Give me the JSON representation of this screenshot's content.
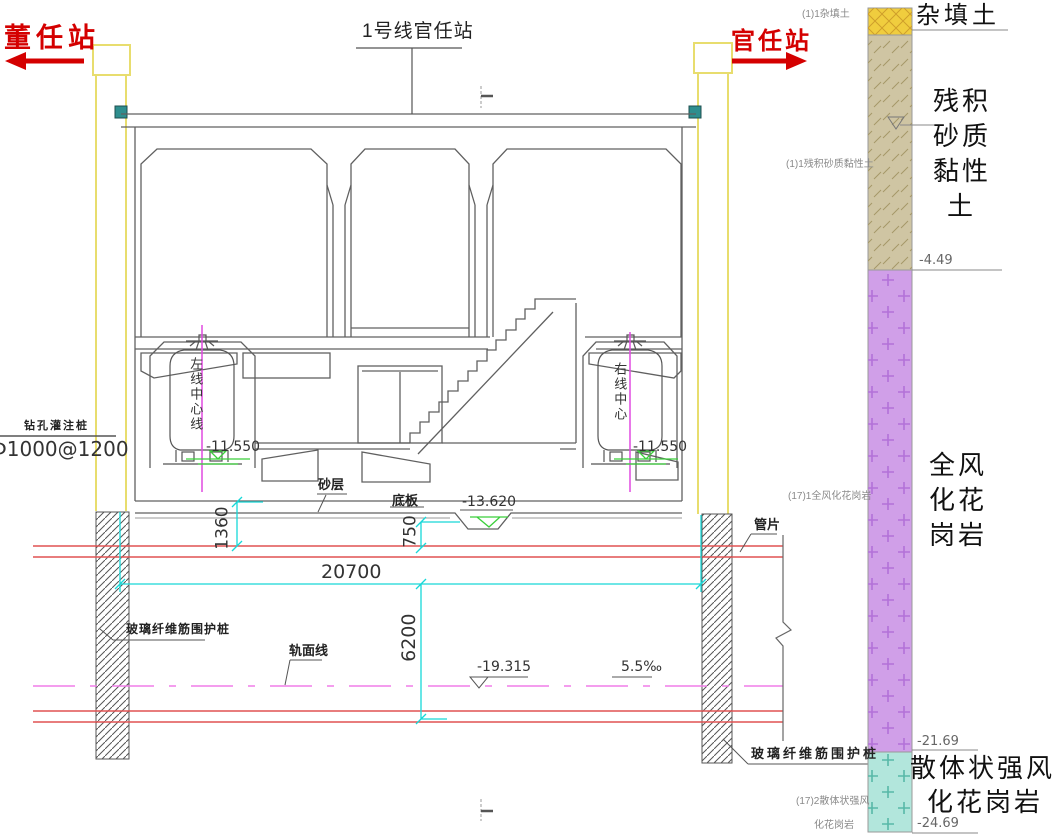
{
  "header": {
    "title": "1号线官任站",
    "left_station": "董任站",
    "right_station": "官任站"
  },
  "annotations": {
    "bored_pile_name": "钻孔灌注桩",
    "bored_pile_spec": "Φ1000@1200",
    "left_center_line": "左线中心线",
    "right_center_line": "右线中心",
    "left_tunnel_elev": "-11.550",
    "right_tunnel_elev": "-11.550",
    "sand_layer": "砂层",
    "base_slab": "底板",
    "sump_elev": "-13.620",
    "segment": "管片",
    "rail_line": "轨面线",
    "rail_elev": "-19.315",
    "slope": "5.5‰",
    "fiberglass_pile_left": "玻璃纤维筋围护桩",
    "fiberglass_pile_right": "玻璃纤维筋围护桩"
  },
  "dimensions": {
    "station_width": "20700",
    "slab_to_tunnel_crown": "1360",
    "sump_depth": "750",
    "tunnel_zone_height": "6200"
  },
  "strata_notes": {
    "fill": "(1)1杂填土",
    "residual": "(1)1残积砂质黏性土",
    "granite_full": "(17)1全风化花岗岩",
    "granite_strong_line1": "(17)2散体状强风",
    "granite_strong_line2": "化花岗岩"
  },
  "geo_column": {
    "fill_label": "杂填土",
    "residual_lines": [
      "残积",
      "砂质",
      "黏性",
      "土"
    ],
    "granite_full_lines": [
      "全风",
      "化花",
      "岗岩"
    ],
    "granite_strong_lines": [
      "散体状强风",
      "化花岗岩"
    ],
    "elev_residual_bottom": "-4.49",
    "elev_granite_full_bottom": "-21.69",
    "elev_granite_strong_bottom": "-24.69",
    "layer_colors": {
      "fill": "#f0cd3e",
      "residual": "#cfc5a3",
      "granite_full": "#d09fe8",
      "granite_strong": "#b2e6dc"
    }
  },
  "colors": {
    "arrow_red": "#d40000",
    "pile_yellow": "#e8dd6e",
    "dimension_cyan": "#17d8d8",
    "center_line_magenta": "#e14ae1",
    "rail_line_pink": "#f07de8",
    "tunnel_segment_red": "#e05252",
    "level_mark_green": "#3bcf3b",
    "wall_plate_teal": "#2e8e8e"
  }
}
